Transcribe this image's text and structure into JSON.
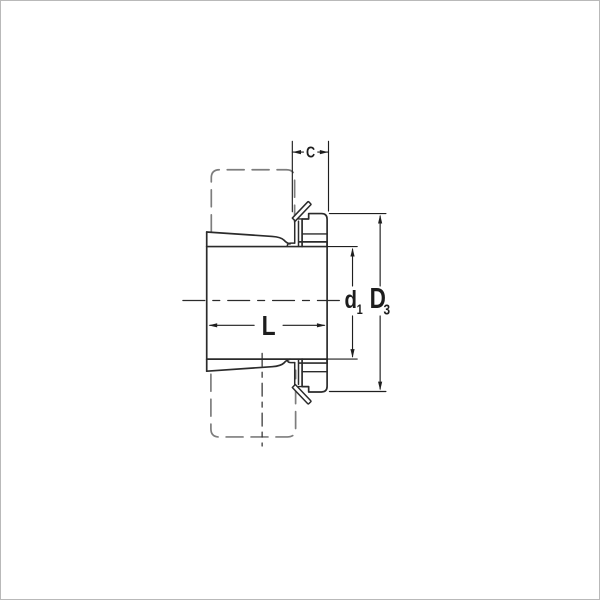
{
  "drawing": {
    "title": "adapter-sleeve-cross-section",
    "dimensions": {
      "c": {
        "base": "C",
        "sub": ""
      },
      "d1": {
        "base": "d",
        "sub": "1"
      },
      "D3": {
        "base": "D",
        "sub": "3"
      },
      "L": {
        "base": "L",
        "sub": ""
      }
    },
    "colors": {
      "outline": "#2b2b2b",
      "phantom": "#7d7d7d",
      "dimension": "#1f1f1f",
      "background": "#ffffff"
    }
  }
}
